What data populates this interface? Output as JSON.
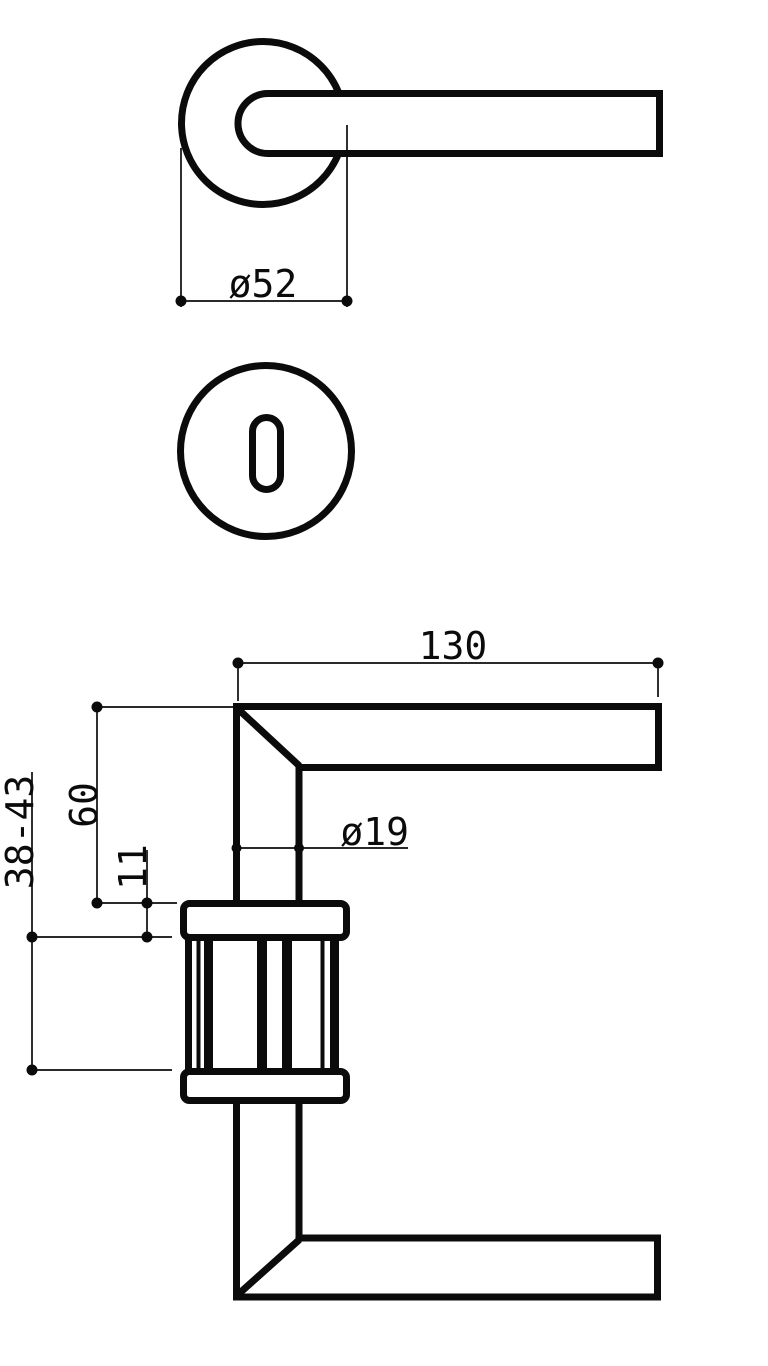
{
  "drawing": {
    "background_color": "#ffffff",
    "line_color": "#0b0b0b",
    "labels": {
      "rose_diameter": "ø52",
      "lever_length": "130",
      "neck_diameter": "ø19",
      "lever_height_above_rose": "60",
      "rose_thickness": "11",
      "door_thickness_range": "38-43"
    }
  }
}
